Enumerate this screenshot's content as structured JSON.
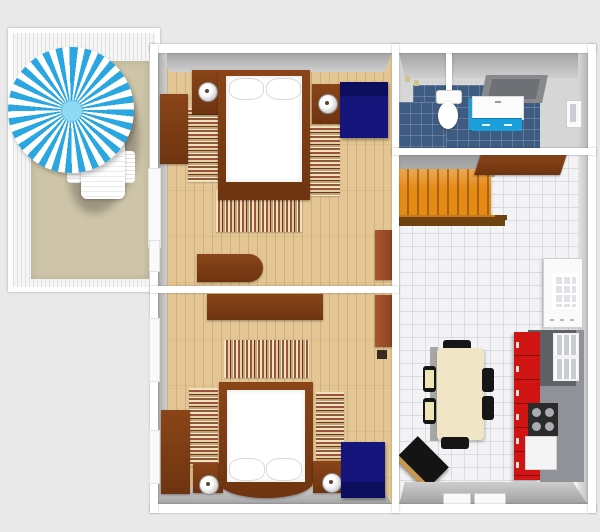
{
  "title": "3D floor plan — two-bedroom apartment with balcony, bathroom and kitchen-diner",
  "colors": {
    "bg": "#e9e9ea",
    "umbrella-blue": "#2aa7e0",
    "wood-floor": "#e4c694",
    "tile-blue": "#3e5c82",
    "kitchen-red": "#d01414",
    "stairs-orange": "#e68a16",
    "navy": "#15157c",
    "sienna": "#a9572e",
    "mat-beige": "#cec4a8",
    "vanity-blue": "#1a9fdb"
  },
  "balcony": {
    "label": "Balcony / terrace",
    "items": {
      "umbrella": "Blue and white striped patio umbrella",
      "lounge_chair": "White lounge chair",
      "mat": "Beige outdoor rug",
      "deck": "White deck boards"
    }
  },
  "bedroom1": {
    "label": "Bedroom 1 (top)",
    "items": {
      "bed": "Double bed, white bedding, dark wood frame",
      "pillow": "Pillow",
      "nightstand_left": "Nightstand with lamp",
      "nightstand_right": "Nightstand with lamp",
      "lamp": "Table lamp",
      "armchair": "Navy blue armchair",
      "wardrobe": "Dark wood wardrobe",
      "dresser": "Dark wood dresser",
      "cabinet": "Tall sienna cabinet",
      "rug_left": "Striped runner rug",
      "rug_right": "Striped runner rug",
      "rug_foot": "Striped rug at foot of bed",
      "balcony_door": "Door to balcony",
      "window": "Window"
    }
  },
  "bedroom2": {
    "label": "Bedroom 2 (bottom)",
    "items": {
      "bed": "Double bed, white bedding, curved footboard",
      "pillow": "Pillow",
      "sideboard": "Dark wood sideboard",
      "nightstand_left": "Nightstand with lamp",
      "nightstand_right": "Nightstand with lamp",
      "lamp": "Table lamp",
      "armchair": "Navy blue armchair",
      "wardrobe": "Dark wood wardrobe",
      "cabinet": "Tall sienna cabinet",
      "rug_left": "Striped runner rug",
      "rug_right": "Striped runner rug",
      "rug_foot": "Striped rug at foot of bed",
      "window_upper": "Window",
      "window_lower": "Window"
    }
  },
  "bathroom": {
    "label": "Bathroom with separate WC",
    "items": {
      "toilet": "Toilet",
      "vanity": "Blue vanity unit with white sink top",
      "shower": "Walk-in shower tray",
      "floor": "Dark blue tiled floor",
      "window": "Window",
      "wall_fixture": "Wall fixture"
    }
  },
  "kitchen": {
    "label": "Kitchen / dining room",
    "items": {
      "stairs": "Orange staircase with handrail",
      "console": "Dark wood console table",
      "dining_table": "Cream dining table",
      "chair": "Black dining chair",
      "kitchen_unit": "Red kitchen cabinet run with grey worktop",
      "upper_cabinets": "Grey upper cabinets with glass panes",
      "cooktop": "Gas cooktop, 4 burners",
      "oven": "White built-in appliance",
      "tv": "Black corner unit",
      "glass_door": "White glass-paned door",
      "windows": "Windows in bottom wall"
    }
  }
}
